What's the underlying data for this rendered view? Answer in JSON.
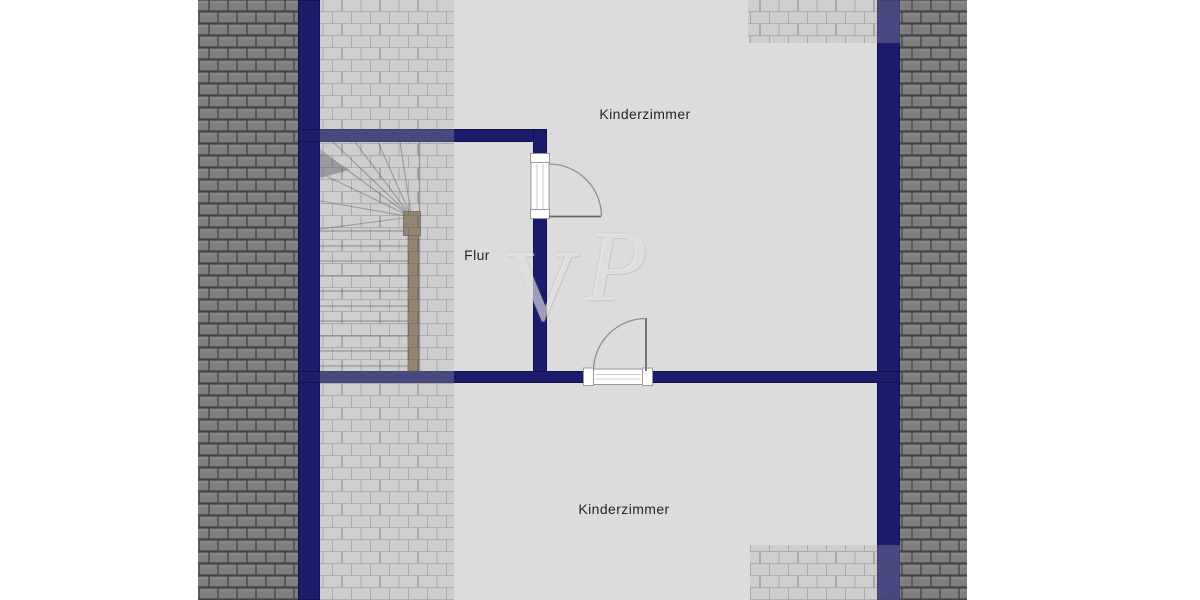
{
  "plan": {
    "type": "floor-plan",
    "floor_shown": "attic-level-partial",
    "rooms": {
      "kinderzimmer_top": {
        "label": "Kinderzimmer"
      },
      "flur": {
        "label": "Flur"
      },
      "kinderzimmer_bottom": {
        "label": "Kinderzimmer"
      }
    },
    "features": {
      "staircase": "winder-staircase-with-handrail",
      "doors": [
        "door-flur-to-kinderzimmer-top",
        "door-to-kinderzimmer-bottom"
      ],
      "roof_tiles": [
        "left-band",
        "right-band",
        "left-slope-overlay",
        "top-right-corner-overlay",
        "bottom-right-corner-overlay"
      ]
    }
  },
  "watermark": {
    "text": "VP",
    "letter_v": "V",
    "letter_p": "P"
  },
  "colors": {
    "page_bg": "#ffffff",
    "wall_navy": "#1b1d6c",
    "floor_gray": "#dcdcdc",
    "tile_face": "#7f7f7f",
    "tile_mortar": "#46464a",
    "overlay_tint": "rgba(172,172,177,0.30)",
    "overlay_line": "rgba(80,84,100,0.30)",
    "handrail_brown": "#8a7254",
    "handrail_edge": "#5c4b37",
    "stair_line": "#8f9094",
    "stair_shadow": "#5a5b64",
    "door_line": "#6a6a6a",
    "door_arc": "#909090",
    "door_frame": "#9a9a9a",
    "label_text": "#262626",
    "watermark_white": "rgba(255,255,255,0.50)"
  }
}
